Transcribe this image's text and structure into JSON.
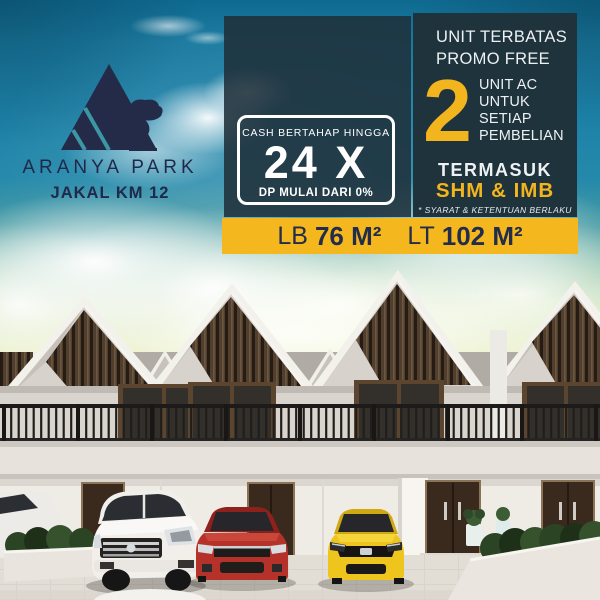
{
  "brand": {
    "name": "ARANYA PARK",
    "location": "JAKAL KM 12",
    "logo": "mountain-a-with-bonsai-tree"
  },
  "promo": {
    "limited_line1": "UNIT TERBATAS",
    "limited_line2": "PROMO FREE",
    "ac_number": "2",
    "ac_lines": [
      "UNIT AC",
      "UNTUK",
      "SETIAP",
      "PEMBELIAN"
    ],
    "include_label": "TERMASUK",
    "include_value": "SHM & IMB",
    "disclaimer": "* SYARAT & KETENTUAN BERLAKU"
  },
  "installment": {
    "heading": "CASH BERTAHAP HINGGA",
    "value": "24 X",
    "note": "DP MULAI DARI 0%"
  },
  "specs": {
    "lb_label": "LB",
    "lb_value": "76 M²",
    "lt_label": "LT",
    "lt_value": "102 M²"
  },
  "scene": {
    "subject": "row of modern two-storey gable townhouses",
    "cars": [
      "white-mpv",
      "red-sedan",
      "yellow-hatchback",
      "white-sedan-partial"
    ]
  },
  "colors": {
    "accent_yellow": "#F2B51E",
    "panel_dark": "#1F333D",
    "text_navy": "#222C4B",
    "sky_teal": "#1D82A8",
    "text_white": "#EDF1F3"
  }
}
